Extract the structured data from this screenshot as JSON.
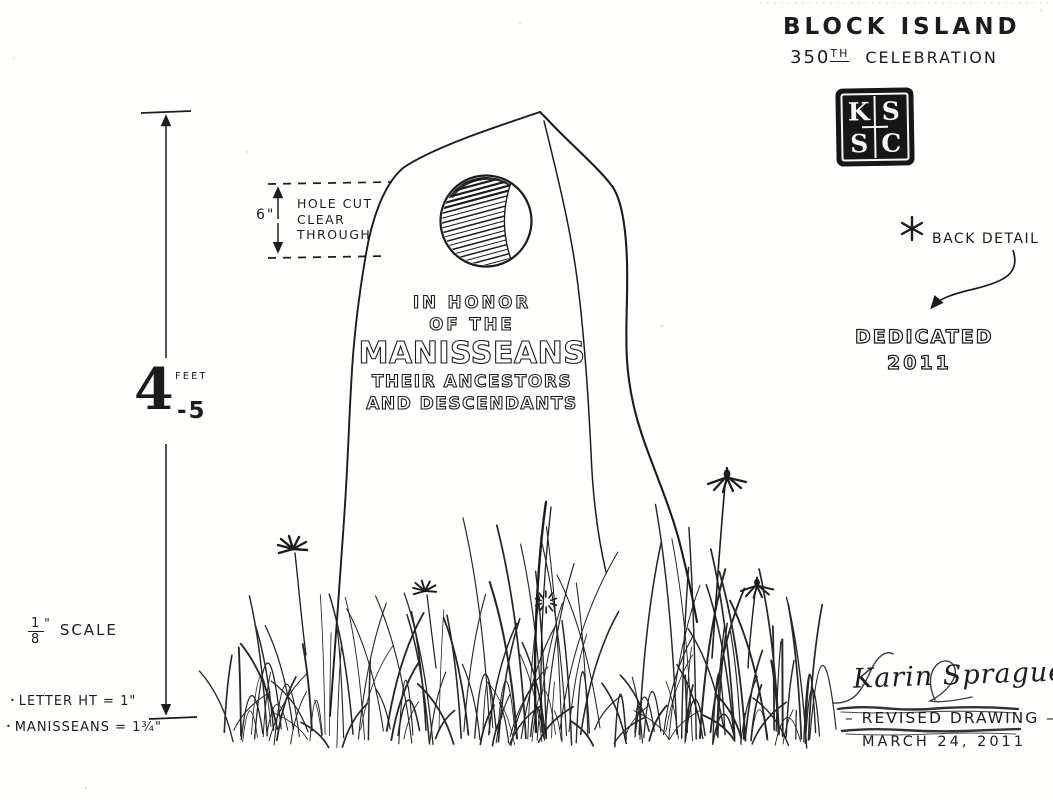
{
  "drawing": {
    "title": {
      "line1": "BLOCK ISLAND",
      "line2_number": "350",
      "line2_sup": "TH",
      "line2_rest": "CELEBRATION"
    },
    "stamp": {
      "top_left": "K",
      "top_right": "S",
      "bottom_left": "S",
      "bottom_right": "C"
    },
    "back_detail": {
      "marker_icon": "asterisk",
      "label": "BACK DETAIL"
    },
    "dedication": {
      "line1": "DEDICATED",
      "line2": "2011"
    },
    "hole_note": {
      "dimension": "6\"",
      "line1": "HOLE CUT",
      "line2": "CLEAR",
      "line3": "THROUGH"
    },
    "height_dimension": {
      "feet": "4",
      "unit": "FEET",
      "inches": "-5"
    },
    "inscription": {
      "line1": "IN HONOR",
      "line2": "OF THE",
      "line3": "MANISSEANS",
      "line4": "THEIR ANCESTORS",
      "line5": "AND DESCENDANTS"
    },
    "scale": {
      "numerator": "1",
      "denominator": "8",
      "mark": "\"",
      "label": "SCALE"
    },
    "notes": {
      "bullet": "•",
      "note1": "LETTER HT = 1\"",
      "note2": "MANISSEANS = 1¾\""
    },
    "signature_block": {
      "signature": "Karin Sprague",
      "status": "– REVISED DRAWING –",
      "date": "MARCH 24, 2011"
    },
    "ink_color": "#1c1c1c",
    "paper_color": "#fffffe"
  }
}
